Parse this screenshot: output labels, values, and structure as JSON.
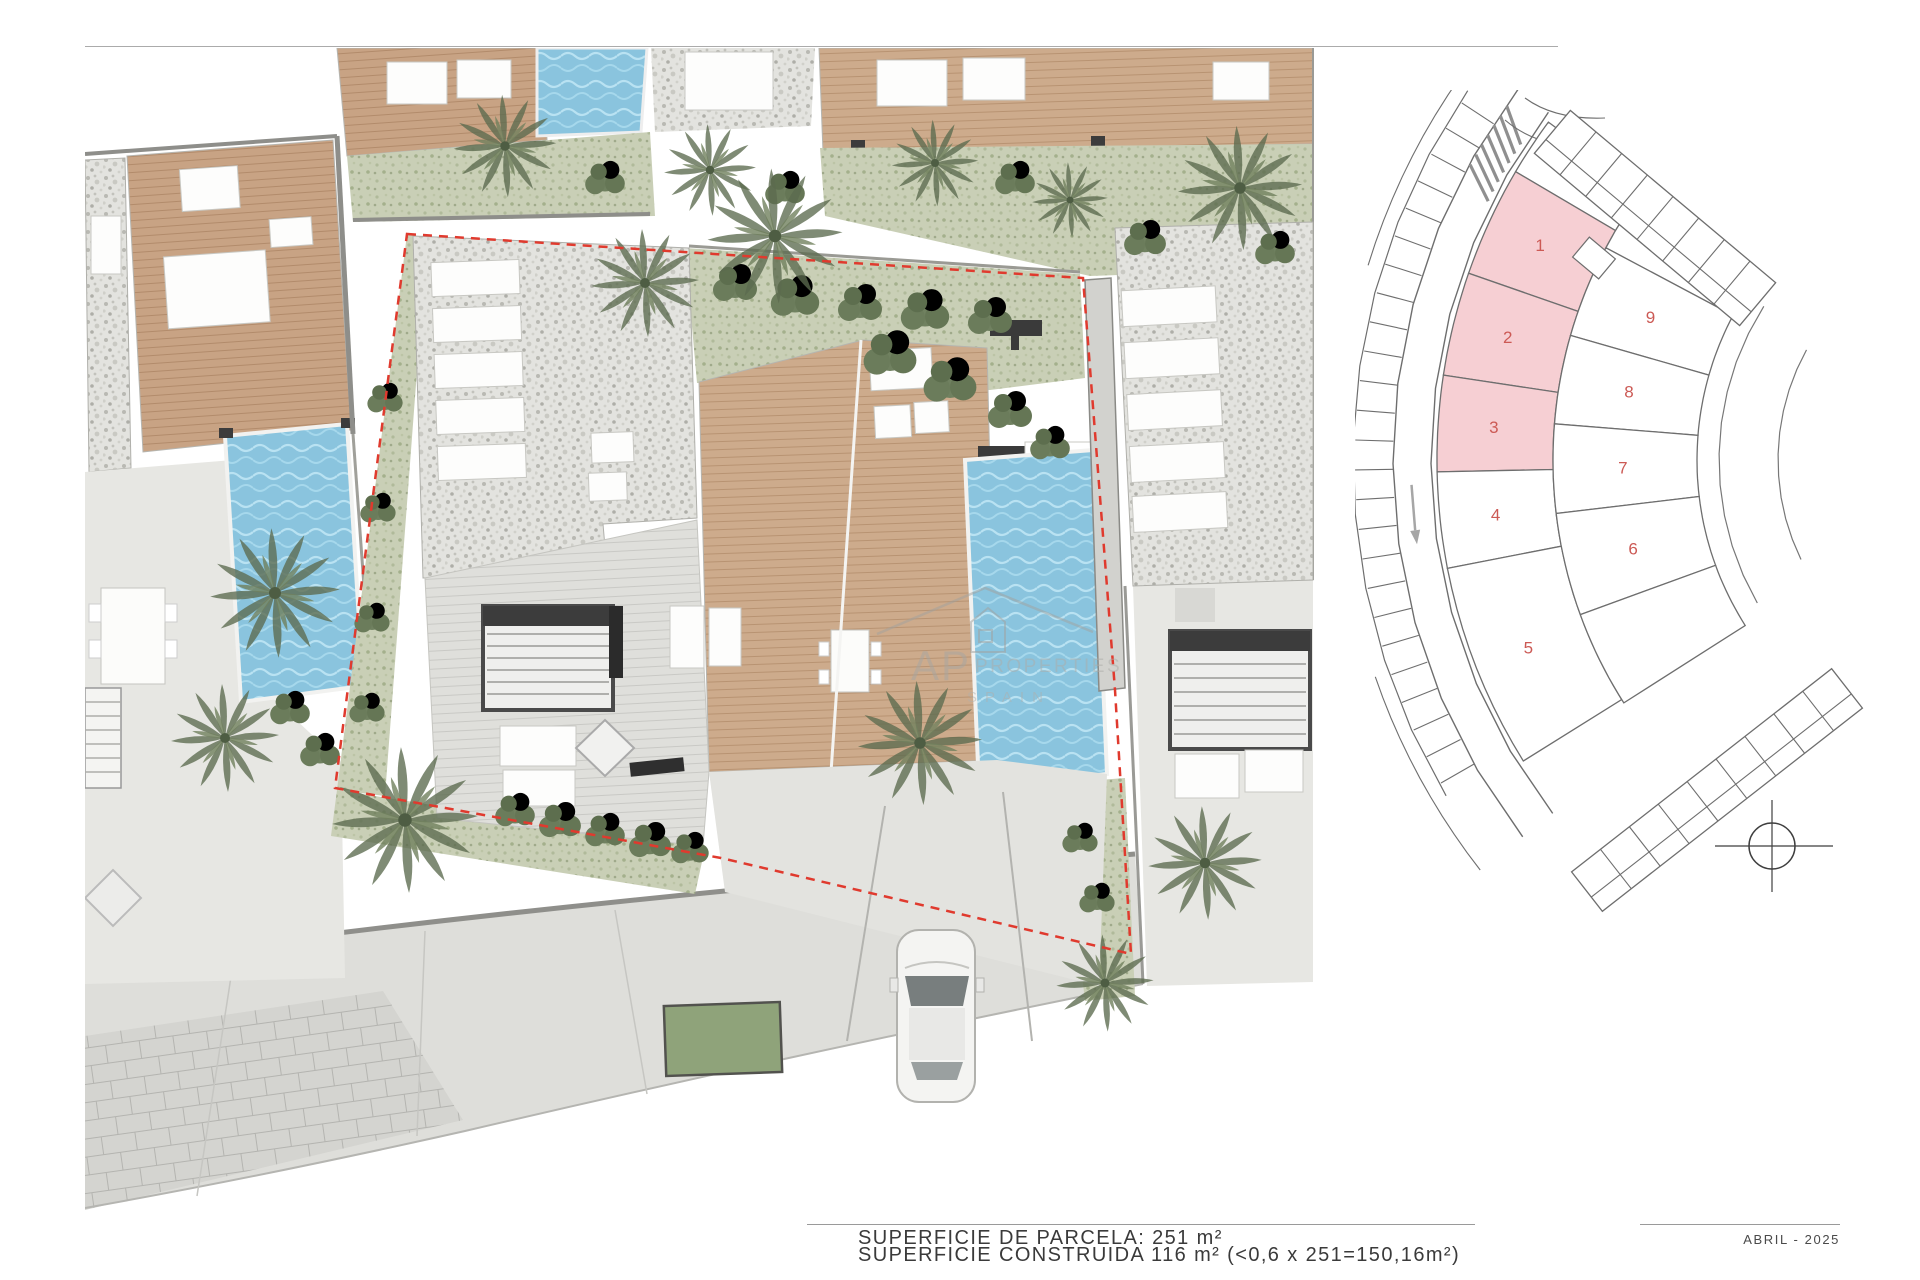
{
  "page": {
    "background": "#ffffff",
    "date": "ABRIL - 2025"
  },
  "footer": {
    "line1": "SUPERFICIE DE PARCELA: 251 m²",
    "line2": "SUPERFICIE CONSTRUIDA 116 m² (<0,6 x 251=150,16m²)"
  },
  "watermark": {
    "initials": "AP",
    "name": "PROPERTIES",
    "sub": "SPAIN"
  },
  "key_plan": {
    "number_color": "#cc5a55",
    "highlight_fill": "#f6cfd3",
    "plot_fill": "#ffffff",
    "plot_stroke": "#6e6e6e",
    "ring_inner_plots": [
      {
        "id": "1",
        "highlighted": true
      },
      {
        "id": "2",
        "highlighted": true
      },
      {
        "id": "3",
        "highlighted": true
      },
      {
        "id": "4",
        "highlighted": false
      },
      {
        "id": "5",
        "highlighted": false
      }
    ],
    "ring_outer_plots": [
      {
        "id": "9",
        "highlighted": false
      },
      {
        "id": "8",
        "highlighted": false
      },
      {
        "id": "7",
        "highlighted": false
      },
      {
        "id": "6",
        "highlighted": false
      }
    ]
  },
  "site_plan": {
    "boundary_color": "#e03a2e",
    "pool_color": "#8ac4de",
    "deck_color": "#c8a384",
    "gravel_color": "#e3e3df",
    "lawn_color": "#c9cfb6",
    "street_color": "#dededa"
  }
}
